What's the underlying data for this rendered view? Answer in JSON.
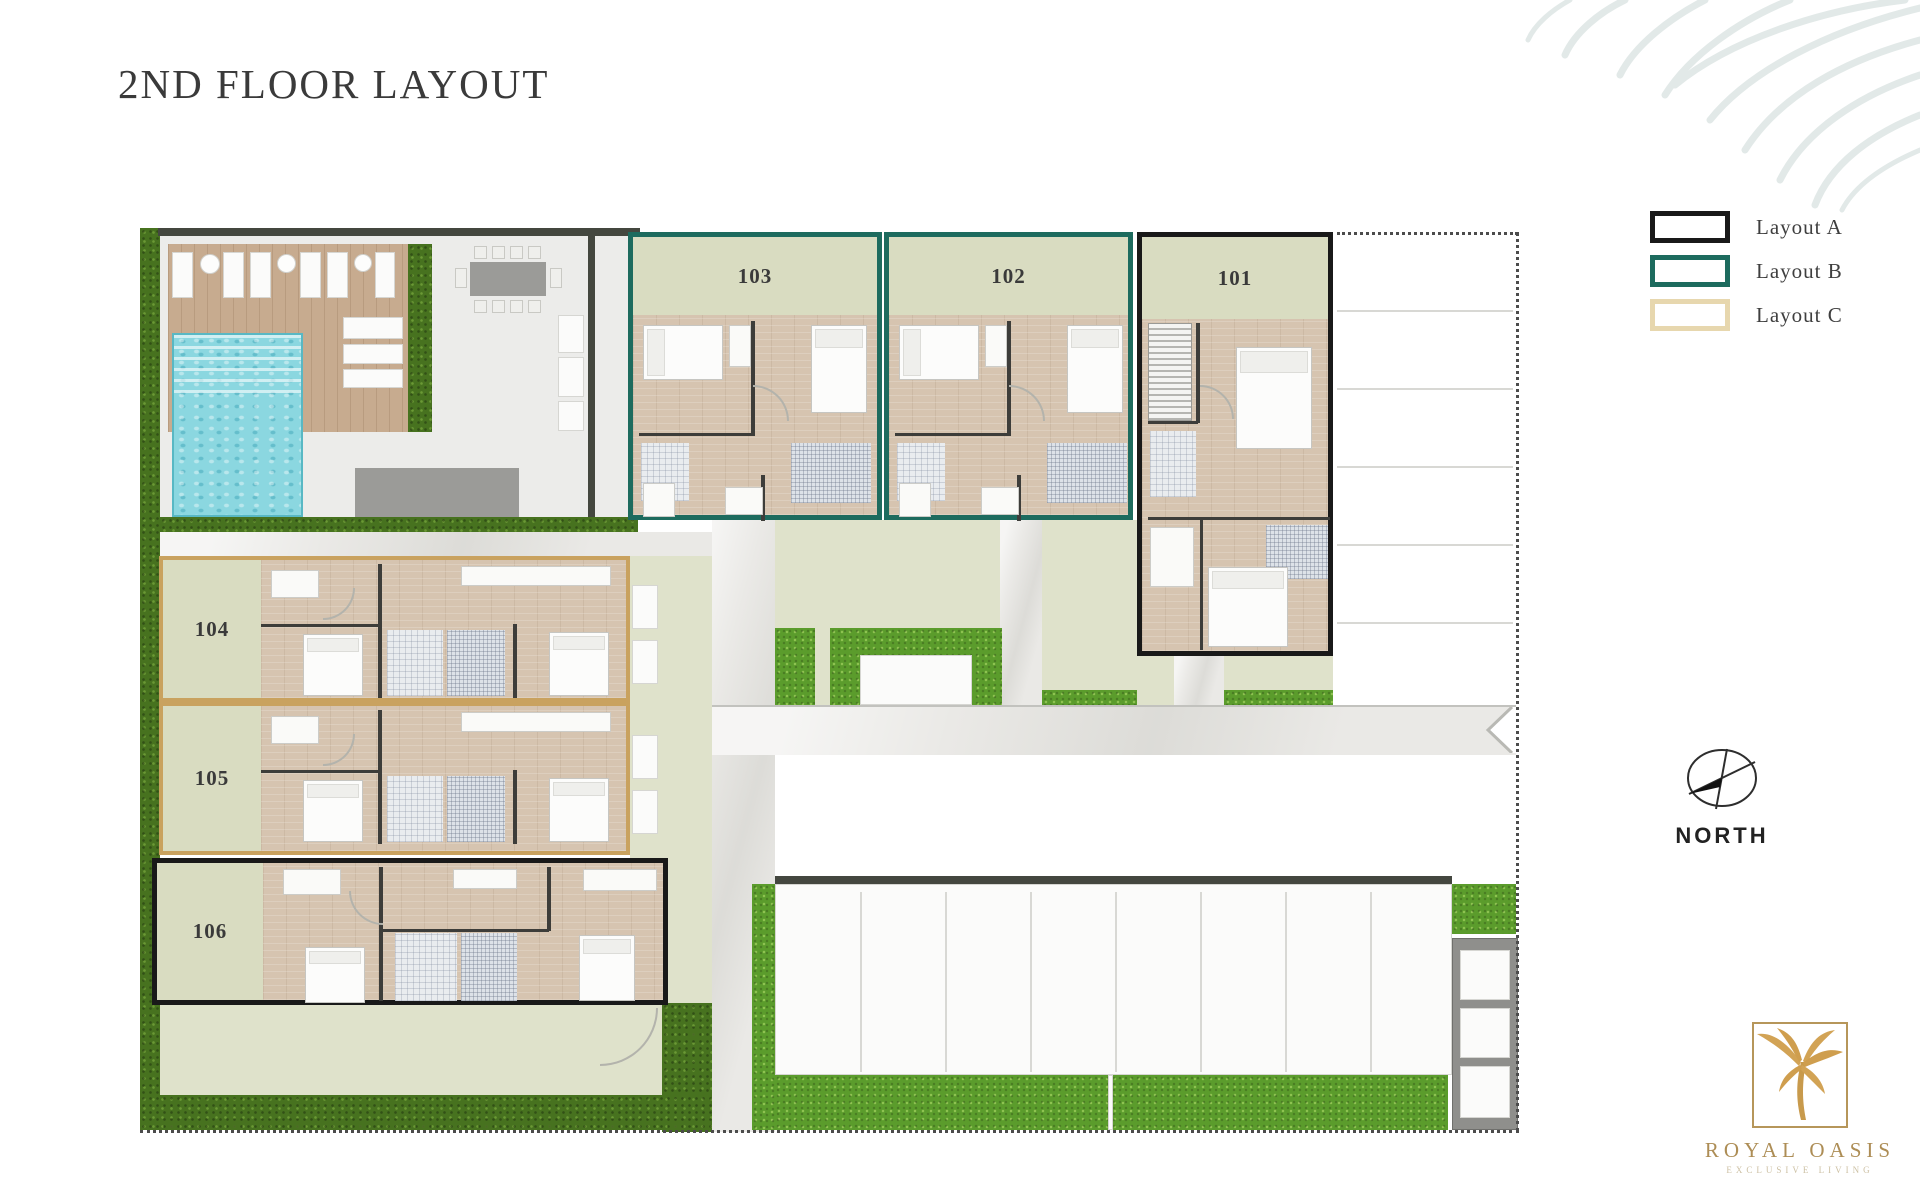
{
  "page": {
    "title": "2ND FLOOR LAYOUT"
  },
  "legend": {
    "items": [
      {
        "label": "Layout A",
        "color": "#191919"
      },
      {
        "label": "Layout B",
        "color": "#1d6b5e"
      },
      {
        "label": "Layout C",
        "color": "#e7d7ae"
      }
    ]
  },
  "north": {
    "label": "NORTH"
  },
  "logo": {
    "name": "ROYAL OASIS",
    "tagline": "EXCLUSIVE LIVING",
    "gold": "#c89a4c"
  },
  "plan": {
    "units": [
      {
        "number": "103",
        "layout": "B",
        "x": 628,
        "y": 232,
        "w": 254,
        "h": 288,
        "band": {
          "side": "top",
          "size": 78
        },
        "interior": "B"
      },
      {
        "number": "102",
        "layout": "B",
        "x": 884,
        "y": 232,
        "w": 249,
        "h": 288,
        "band": {
          "side": "top",
          "size": 78
        },
        "interior": "B"
      },
      {
        "number": "101",
        "layout": "A",
        "x": 1137,
        "y": 232,
        "w": 196,
        "h": 424,
        "band": {
          "side": "top",
          "size": 82
        },
        "interior": "A101"
      },
      {
        "number": "104",
        "layout": "C",
        "x": 159,
        "y": 556,
        "w": 471,
        "h": 146,
        "band": {
          "side": "left",
          "size": 98
        },
        "interior": "C"
      },
      {
        "number": "105",
        "layout": "C",
        "x": 159,
        "y": 702,
        "w": 471,
        "h": 153,
        "band": {
          "side": "left",
          "size": 98
        },
        "interior": "C"
      },
      {
        "number": "106",
        "layout": "A",
        "x": 152,
        "y": 858,
        "w": 516,
        "h": 147,
        "band": {
          "side": "left",
          "size": 106
        },
        "interior": "A106"
      }
    ],
    "interiors": {
      "B": [
        {
          "t": "wall",
          "x": 118,
          "y": 84,
          "w": 4,
          "h": 114
        },
        {
          "t": "wall",
          "x": 6,
          "y": 196,
          "w": 116,
          "h": 3
        },
        {
          "t": "wall",
          "x": 128,
          "y": 238,
          "w": 4,
          "h": 46
        },
        {
          "t": "bed",
          "d": "h",
          "x": 10,
          "y": 88,
          "w": 80,
          "h": 55
        },
        {
          "t": "bed",
          "d": "v",
          "x": 178,
          "y": 88,
          "w": 56,
          "h": 88
        },
        {
          "t": "white",
          "x": 96,
          "y": 88,
          "w": 22,
          "h": 42
        },
        {
          "t": "tile",
          "x": 8,
          "y": 206,
          "w": 48,
          "h": 58
        },
        {
          "t": "hatch",
          "x": 158,
          "y": 206,
          "w": 80,
          "h": 60
        },
        {
          "t": "white",
          "x": 10,
          "y": 246,
          "w": 32,
          "h": 34
        },
        {
          "t": "white",
          "x": 92,
          "y": 250,
          "w": 38,
          "h": 28
        },
        {
          "t": "arc",
          "x": 120,
          "y": 148,
          "w": 36,
          "h": 36,
          "c": "tr"
        }
      ],
      "C": [
        {
          "t": "wall",
          "x": 215,
          "y": 4,
          "w": 4,
          "h": 134
        },
        {
          "t": "wall",
          "x": 350,
          "y": 64,
          "w": 4,
          "h": 74
        },
        {
          "t": "wall",
          "x": 98,
          "y": 64,
          "w": 120,
          "h": 3
        },
        {
          "t": "white",
          "x": 108,
          "y": 10,
          "w": 48,
          "h": 28
        },
        {
          "t": "white",
          "x": 298,
          "y": 6,
          "w": 150,
          "h": 20
        },
        {
          "t": "bed",
          "d": "v",
          "x": 140,
          "y": 74,
          "w": 60,
          "h": 62
        },
        {
          "t": "tile",
          "x": 224,
          "y": 70,
          "w": 56,
          "h": 66
        },
        {
          "t": "hatch",
          "x": 284,
          "y": 70,
          "w": 58,
          "h": 66
        },
        {
          "t": "bed",
          "d": "v",
          "x": 386,
          "y": 72,
          "w": 60,
          "h": 64
        },
        {
          "t": "arc",
          "x": 160,
          "y": 28,
          "w": 32,
          "h": 32,
          "c": "br"
        }
      ],
      "A106": [
        {
          "t": "wall",
          "x": 222,
          "y": 4,
          "w": 4,
          "h": 134
        },
        {
          "t": "wall",
          "x": 390,
          "y": 4,
          "w": 4,
          "h": 64
        },
        {
          "t": "wall",
          "x": 226,
          "y": 66,
          "w": 166,
          "h": 3
        },
        {
          "t": "white",
          "x": 126,
          "y": 6,
          "w": 58,
          "h": 26
        },
        {
          "t": "white",
          "x": 296,
          "y": 6,
          "w": 64,
          "h": 20
        },
        {
          "t": "white",
          "x": 426,
          "y": 6,
          "w": 74,
          "h": 22
        },
        {
          "t": "bed",
          "d": "v",
          "x": 148,
          "y": 84,
          "w": 60,
          "h": 56
        },
        {
          "t": "tile",
          "x": 238,
          "y": 70,
          "w": 62,
          "h": 68
        },
        {
          "t": "hatch",
          "x": 304,
          "y": 70,
          "w": 56,
          "h": 68
        },
        {
          "t": "bed",
          "d": "v",
          "x": 422,
          "y": 72,
          "w": 56,
          "h": 66
        },
        {
          "t": "arc",
          "x": 192,
          "y": 28,
          "w": 34,
          "h": 34,
          "c": "bl"
        }
      ],
      "A101": [
        {
          "t": "stairs",
          "x": 6,
          "y": 86,
          "w": 44,
          "h": 98
        },
        {
          "t": "wall",
          "x": 54,
          "y": 86,
          "w": 4,
          "h": 100
        },
        {
          "t": "wall",
          "x": 6,
          "y": 184,
          "w": 50,
          "h": 3
        },
        {
          "t": "wall",
          "x": 6,
          "y": 280,
          "w": 182,
          "h": 3
        },
        {
          "t": "wall",
          "x": 58,
          "y": 283,
          "w": 3,
          "h": 130
        },
        {
          "t": "bed",
          "d": "v",
          "x": 94,
          "y": 110,
          "w": 76,
          "h": 102
        },
        {
          "t": "tile",
          "x": 8,
          "y": 194,
          "w": 46,
          "h": 66
        },
        {
          "t": "white",
          "x": 8,
          "y": 290,
          "w": 44,
          "h": 60
        },
        {
          "t": "hatch",
          "x": 124,
          "y": 288,
          "w": 62,
          "h": 54
        },
        {
          "t": "bed",
          "d": "v",
          "x": 66,
          "y": 330,
          "w": 80,
          "h": 80
        },
        {
          "t": "arc",
          "x": 58,
          "y": 148,
          "w": 34,
          "h": 34,
          "c": "tr"
        }
      ]
    },
    "zones": [
      {
        "n": "hedge-left-column",
        "t": "hedge",
        "x": 140,
        "y": 228,
        "w": 20,
        "h": 902
      },
      {
        "n": "amenity-paving",
        "t": "paving",
        "x": 160,
        "y": 236,
        "w": 478,
        "h": 296
      },
      {
        "n": "amenity-top-wall",
        "t": "wall",
        "x": 158,
        "y": 228,
        "w": 482,
        "h": 8
      },
      {
        "n": "amenity-right-wall",
        "t": "wall",
        "x": 588,
        "y": 236,
        "w": 7,
        "h": 296
      },
      {
        "n": "pool-deck",
        "t": "deck",
        "x": 168,
        "y": 244,
        "w": 240,
        "h": 188
      },
      {
        "n": "sun-lounger",
        "t": "white",
        "x": 172,
        "y": 252,
        "w": 21,
        "h": 46
      },
      {
        "n": "side-table",
        "t": "whitec",
        "x": 200,
        "y": 254,
        "w": 20,
        "h": 20
      },
      {
        "n": "sun-lounger",
        "t": "white",
        "x": 223,
        "y": 252,
        "w": 21,
        "h": 46
      },
      {
        "n": "sun-lounger",
        "t": "white",
        "x": 250,
        "y": 252,
        "w": 21,
        "h": 46
      },
      {
        "n": "side-table",
        "t": "whitec",
        "x": 277,
        "y": 254,
        "w": 19,
        "h": 19
      },
      {
        "n": "sun-lounger",
        "t": "white",
        "x": 300,
        "y": 252,
        "w": 21,
        "h": 46
      },
      {
        "n": "sun-lounger",
        "t": "white",
        "x": 327,
        "y": 252,
        "w": 21,
        "h": 46
      },
      {
        "n": "side-table",
        "t": "whitec",
        "x": 354,
        "y": 254,
        "w": 18,
        "h": 18
      },
      {
        "n": "sun-lounger",
        "t": "white",
        "x": 375,
        "y": 252,
        "w": 20,
        "h": 46
      },
      {
        "n": "pool",
        "t": "pool",
        "x": 172,
        "y": 333,
        "w": 131,
        "h": 184
      },
      {
        "n": "pool-steps",
        "t": "steps",
        "x": 174,
        "y": 335,
        "w": 127,
        "h": 58
      },
      {
        "n": "pool-bench",
        "t": "white",
        "x": 343,
        "y": 317,
        "w": 60,
        "h": 22
      },
      {
        "n": "pool-bench",
        "t": "white",
        "x": 343,
        "y": 344,
        "w": 60,
        "h": 20
      },
      {
        "n": "pool-bench",
        "t": "white",
        "x": 343,
        "y": 369,
        "w": 60,
        "h": 19
      },
      {
        "n": "dining-table",
        "t": "gray",
        "x": 470,
        "y": 262,
        "w": 76,
        "h": 34
      },
      {
        "n": "dining-chair",
        "t": "chair",
        "x": 474,
        "y": 246,
        "w": 13,
        "h": 13
      },
      {
        "n": "dining-chair",
        "t": "chair",
        "x": 492,
        "y": 246,
        "w": 13,
        "h": 13
      },
      {
        "n": "dining-chair",
        "t": "chair",
        "x": 510,
        "y": 246,
        "w": 13,
        "h": 13
      },
      {
        "n": "dining-chair",
        "t": "chair",
        "x": 528,
        "y": 246,
        "w": 13,
        "h": 13
      },
      {
        "n": "dining-chair",
        "t": "chair",
        "x": 474,
        "y": 300,
        "w": 13,
        "h": 13
      },
      {
        "n": "dining-chair",
        "t": "chair",
        "x": 492,
        "y": 300,
        "w": 13,
        "h": 13
      },
      {
        "n": "dining-chair",
        "t": "chair",
        "x": 510,
        "y": 300,
        "w": 13,
        "h": 13
      },
      {
        "n": "dining-chair",
        "t": "chair",
        "x": 528,
        "y": 300,
        "w": 13,
        "h": 13
      },
      {
        "n": "dining-chair",
        "t": "chair",
        "x": 455,
        "y": 268,
        "w": 12,
        "h": 20
      },
      {
        "n": "dining-chair",
        "t": "chair",
        "x": 550,
        "y": 268,
        "w": 12,
        "h": 20
      },
      {
        "n": "outdoor-sofa",
        "t": "white",
        "x": 558,
        "y": 315,
        "w": 26,
        "h": 38
      },
      {
        "n": "outdoor-sofa",
        "t": "white",
        "x": 558,
        "y": 357,
        "w": 26,
        "h": 40
      },
      {
        "n": "outdoor-sofa",
        "t": "white",
        "x": 558,
        "y": 401,
        "w": 26,
        "h": 30
      },
      {
        "n": "storage-block",
        "t": "gray",
        "x": 355,
        "y": 468,
        "w": 164,
        "h": 49
      },
      {
        "n": "amenity-hedge-mid",
        "t": "hedge",
        "x": 408,
        "y": 244,
        "w": 24,
        "h": 188
      },
      {
        "n": "amenity-hedge-bottom",
        "t": "hedge",
        "x": 160,
        "y": 517,
        "w": 478,
        "h": 15
      },
      {
        "n": "path-corridor",
        "t": "road",
        "x": 160,
        "y": 532,
        "w": 552,
        "h": 24
      },
      {
        "n": "side-sage-right-of-104",
        "t": "sage",
        "x": 630,
        "y": 556,
        "w": 82,
        "h": 447
      },
      {
        "n": "balcony",
        "t": "white",
        "x": 632,
        "y": 585,
        "w": 26,
        "h": 44
      },
      {
        "n": "balcony",
        "t": "white",
        "x": 632,
        "y": 640,
        "w": 26,
        "h": 44
      },
      {
        "n": "balcony",
        "t": "white",
        "x": 632,
        "y": 735,
        "w": 26,
        "h": 44
      },
      {
        "n": "balcony",
        "t": "white",
        "x": 632,
        "y": 790,
        "w": 26,
        "h": 44
      },
      {
        "n": "road-vertical",
        "t": "road",
        "x": 712,
        "y": 440,
        "w": 63,
        "h": 692
      },
      {
        "n": "courtyard-sage",
        "t": "sage",
        "x": 775,
        "y": 520,
        "w": 362,
        "h": 185
      },
      {
        "n": "court-path",
        "t": "road",
        "x": 1000,
        "y": 520,
        "w": 42,
        "h": 185
      },
      {
        "n": "court-grass",
        "t": "grass",
        "x": 775,
        "y": 628,
        "w": 40,
        "h": 77
      },
      {
        "n": "court-grass",
        "t": "grass",
        "x": 830,
        "y": 628,
        "w": 172,
        "h": 77
      },
      {
        "n": "pergola",
        "t": "white",
        "x": 860,
        "y": 655,
        "w": 112,
        "h": 50
      },
      {
        "n": "court-grass-strip",
        "t": "grass",
        "x": 1042,
        "y": 690,
        "w": 95,
        "h": 15
      },
      {
        "n": "sage-under-101-left",
        "t": "sage",
        "x": 1137,
        "y": 656,
        "w": 37,
        "h": 49
      },
      {
        "n": "road-under-101",
        "t": "road",
        "x": 1174,
        "y": 656,
        "w": 50,
        "h": 49
      },
      {
        "n": "sage-under-101-right",
        "t": "sage",
        "x": 1224,
        "y": 656,
        "w": 109,
        "h": 34
      },
      {
        "n": "grass-under-101",
        "t": "grass",
        "x": 1224,
        "y": 690,
        "w": 109,
        "h": 15
      },
      {
        "n": "road-horizontal",
        "t": "road",
        "x": 712,
        "y": 705,
        "w": 804,
        "h": 50
      },
      {
        "n": "road-edge-top",
        "t": "edge",
        "x": 712,
        "y": 705,
        "w": 804,
        "h": 2
      },
      {
        "n": "road-chevron",
        "t": "chev",
        "x": 1478,
        "y": 707,
        "w": 38,
        "h": 46
      },
      {
        "n": "sage-below-106",
        "t": "sage",
        "x": 160,
        "y": 1003,
        "w": 502,
        "h": 92
      },
      {
        "n": "gate-arc",
        "t": "arc",
        "x": 600,
        "y": 1008,
        "w": 58,
        "h": 58,
        "c": "br"
      },
      {
        "n": "hedge-col-east-of-sage",
        "t": "hedge",
        "x": 662,
        "y": 1003,
        "w": 50,
        "h": 129
      },
      {
        "n": "hedge-bottom-left",
        "t": "hedge",
        "x": 140,
        "y": 1095,
        "w": 572,
        "h": 35
      },
      {
        "n": "parking-top-wall",
        "t": "wall",
        "x": 775,
        "y": 876,
        "w": 677,
        "h": 8
      },
      {
        "n": "parking-area",
        "t": "white",
        "x": 775,
        "y": 884,
        "w": 677,
        "h": 191
      },
      {
        "n": "parking-stall-lines",
        "t": "vlines",
        "x": 860,
        "y": 892,
        "w": 512,
        "h": 180,
        "count": 7,
        "step": 85
      },
      {
        "n": "parking-grass-left",
        "t": "grass",
        "x": 752,
        "y": 884,
        "w": 23,
        "h": 246
      },
      {
        "n": "parking-grass-bottom",
        "t": "grass",
        "x": 775,
        "y": 1075,
        "w": 673,
        "h": 55
      },
      {
        "n": "grass-gap",
        "t": "white",
        "x": 1108,
        "y": 1075,
        "w": 5,
        "h": 55
      },
      {
        "n": "storage-structure",
        "t": "grayframe",
        "x": 1452,
        "y": 938,
        "w": 66,
        "h": 192
      },
      {
        "n": "storage-cell",
        "t": "white",
        "x": 1460,
        "y": 950,
        "w": 50,
        "h": 50
      },
      {
        "n": "storage-cell",
        "t": "white",
        "x": 1460,
        "y": 1008,
        "w": 50,
        "h": 50
      },
      {
        "n": "storage-cell",
        "t": "white",
        "x": 1460,
        "y": 1066,
        "w": 50,
        "h": 52
      },
      {
        "n": "structure-grass-top",
        "t": "grass",
        "x": 1452,
        "y": 884,
        "w": 64,
        "h": 50
      },
      {
        "n": "east-parking-lines",
        "t": "hlines",
        "x": 1337,
        "y": 310,
        "w": 176,
        "h": 314,
        "count": 5,
        "step": 78
      },
      {
        "n": "boundary-dotted-top",
        "t": "dot-h",
        "x": 1337,
        "y": 232,
        "w": 181,
        "h": 3
      },
      {
        "n": "boundary-dotted-right",
        "t": "dot-v",
        "x": 1516,
        "y": 232,
        "w": 3,
        "h": 900
      },
      {
        "n": "boundary-dotted-bottom",
        "t": "dot-h",
        "x": 140,
        "y": 1130,
        "w": 1379,
        "h": 3
      }
    ]
  }
}
